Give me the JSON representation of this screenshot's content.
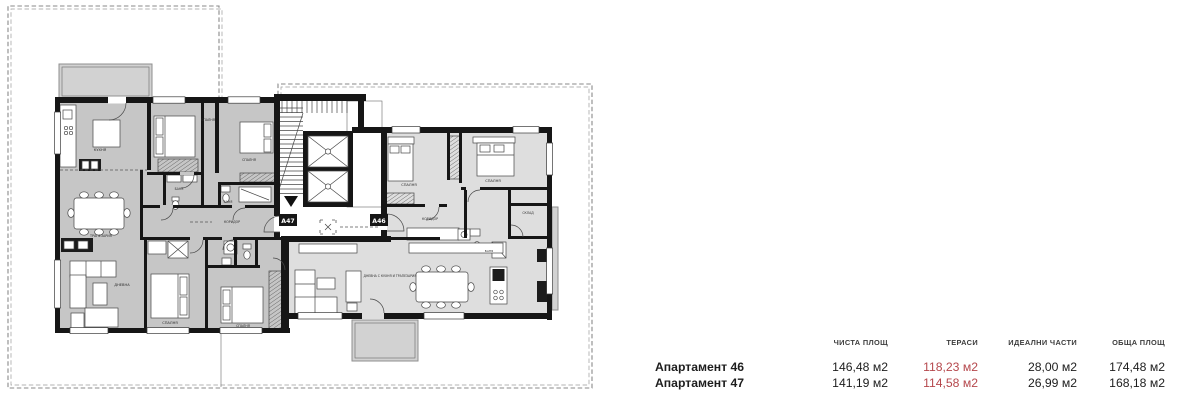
{
  "colors": {
    "wall": "#161616",
    "a47": "#c6c6c6",
    "a46": "#dedede",
    "terrace": "#d2d2d2",
    "accent": "#b5474c"
  },
  "plan": {
    "apartment_codes": [
      {
        "label": "А47"
      },
      {
        "label": "А46"
      }
    ],
    "room_labels": [
      {
        "text": "КУХНЯ",
        "x": 100,
        "y": 151
      },
      {
        "text": "СПАЛНЯ",
        "x": 208,
        "y": 121,
        "size": 3.2
      },
      {
        "text": "СПАЛНЯ",
        "x": 249,
        "y": 161,
        "size": 3.2
      },
      {
        "text": "БАНЯ",
        "x": 179,
        "y": 190,
        "size": 3.1
      },
      {
        "text": "БАНЯ",
        "x": 228,
        "y": 203,
        "size": 3.1
      },
      {
        "text": "КОРИДОР",
        "x": 232,
        "y": 223,
        "size": 3.2
      },
      {
        "text": "ТРАПЕЗАРИЯ",
        "x": 101,
        "y": 237,
        "size": 3.3
      },
      {
        "text": "ДНЕВНА",
        "x": 122,
        "y": 286
      },
      {
        "text": "СПАЛНЯ",
        "x": 170,
        "y": 324
      },
      {
        "text": "СПАЛНЯ",
        "x": 243,
        "y": 327,
        "size": 3.2
      },
      {
        "text": "СПАЛНЯ",
        "x": 409,
        "y": 186
      },
      {
        "text": "СПАЛНЯ",
        "x": 493,
        "y": 182
      },
      {
        "text": "КОРИДОР",
        "x": 430,
        "y": 220,
        "size": 3.2
      },
      {
        "text": "БАНЯ",
        "x": 489,
        "y": 252,
        "size": 3
      },
      {
        "text": "СКЛАД",
        "x": 528,
        "y": 214,
        "size": 3.1
      },
      {
        "text": "ДНЕВНА С КУХНЯ И ТРАПЕЗАРИЯ",
        "x": 390,
        "y": 277,
        "size": 3.1
      }
    ]
  },
  "table": {
    "headers": [
      "ЧИСТА ПЛОЩ",
      "ТЕРАСИ",
      "ИДЕАЛНИ ЧАСТИ",
      "ОБЩА ПЛОЩ"
    ],
    "rows": [
      {
        "label": "Апартамент 46",
        "values": [
          "146,48 м2",
          "118,23 м2",
          "28,00 м2",
          "174,48 м2"
        ]
      },
      {
        "label": "Апартамент 47",
        "values": [
          "141,19 м2",
          "114,58 м2",
          "26,99 м2",
          "168,18 м2"
        ]
      }
    ]
  }
}
